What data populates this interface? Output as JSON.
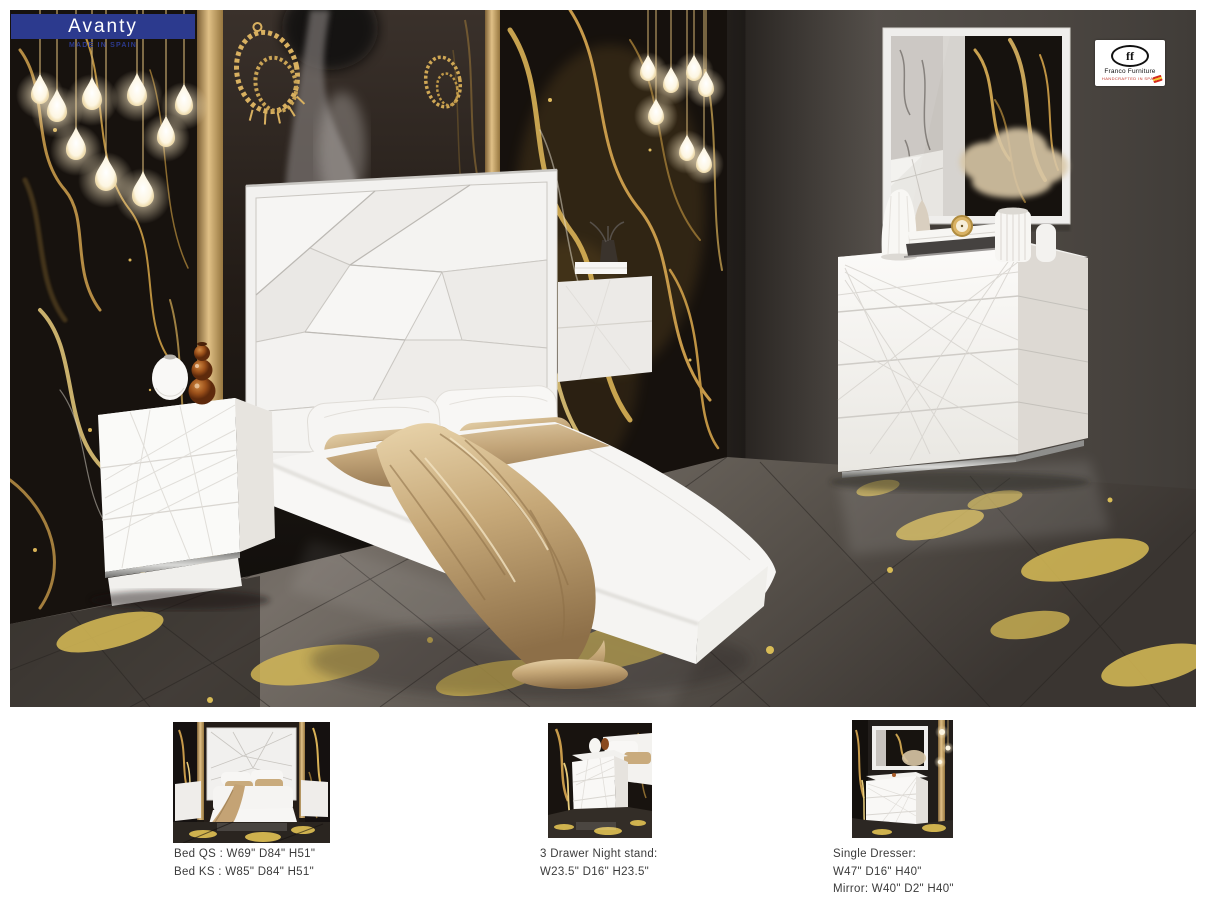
{
  "header": {
    "collection": "Avanty",
    "made_in": "MADE IN SPAIN"
  },
  "brand": {
    "monogram": "ff",
    "name": "Franco Furniture",
    "tagline": "HANDCRAFTED IN SPAIN"
  },
  "products": [
    {
      "name": "Bed",
      "caption": [
        "Bed QS : W69\" D84\" H51\"",
        "Bed KS : W85\" D84\" H51\""
      ]
    },
    {
      "name": "3 Drawer Night stand",
      "caption": [
        "3 Drawer Night stand:",
        "W23.5\" D16\" H23.5\""
      ]
    },
    {
      "name": "Single Dresser and Mirror",
      "caption": [
        "Single Dresser:",
        "W47\" D16\" H40\"",
        "Mirror: W40\" D2\" H40\""
      ]
    }
  ],
  "colors": {
    "banner": "#2c3a8e",
    "brand-red": "#c03226",
    "caption": "#3b3b3b",
    "gold": "#c9a15a",
    "wall": "#56514b",
    "marble": "#14100d",
    "floor-gold": "#d8bc56"
  }
}
